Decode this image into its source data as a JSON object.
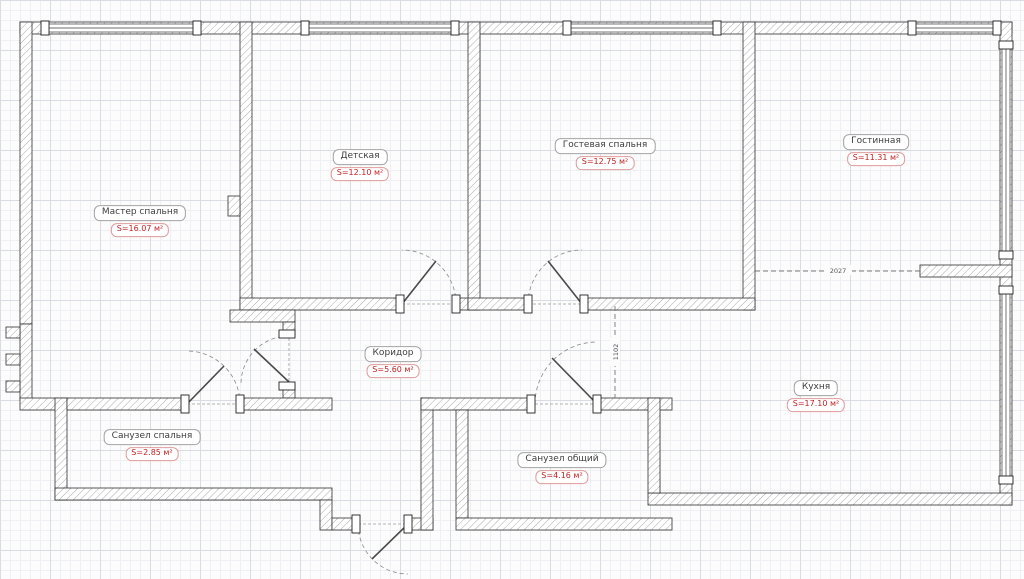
{
  "document": {
    "type": "apartment-floor-plan"
  },
  "rooms": [
    {
      "id": "master-bedroom",
      "name": "Мастер спальня",
      "area": "S=16.07 м²"
    },
    {
      "id": "kids-room",
      "name": "Детская",
      "area": "S=12.10 м²"
    },
    {
      "id": "guest-bedroom",
      "name": "Гостевая спальня",
      "area": "S=12.75 м²"
    },
    {
      "id": "living-room",
      "name": "Гостинная",
      "area": "S=11.31 м²"
    },
    {
      "id": "corridor",
      "name": "Коридор",
      "area": "S=5.60 м²"
    },
    {
      "id": "kitchen",
      "name": "Кухня",
      "area": "S=17.10 м²"
    },
    {
      "id": "bathroom-master",
      "name": "Санузел спальня",
      "area": "S=2.85 м²"
    },
    {
      "id": "bathroom-shared",
      "name": "Санузел общий",
      "area": "S=4.16 м²"
    }
  ],
  "dimensions": {
    "kitchen_living_opening": "2027",
    "corridor_kitchen_opening": "1102"
  },
  "colors": {
    "wall_outline": "#2e2e2e",
    "wall_hatch": "#a9a9a9",
    "room_name_text": "#3d3d3d",
    "room_name_border": "#a3a3a3",
    "area_text": "#c22222",
    "area_border": "#e09b9b",
    "dashed_line": "#777777",
    "grid_major": "#d9dde3",
    "grid_minor": "#eef0f4"
  }
}
